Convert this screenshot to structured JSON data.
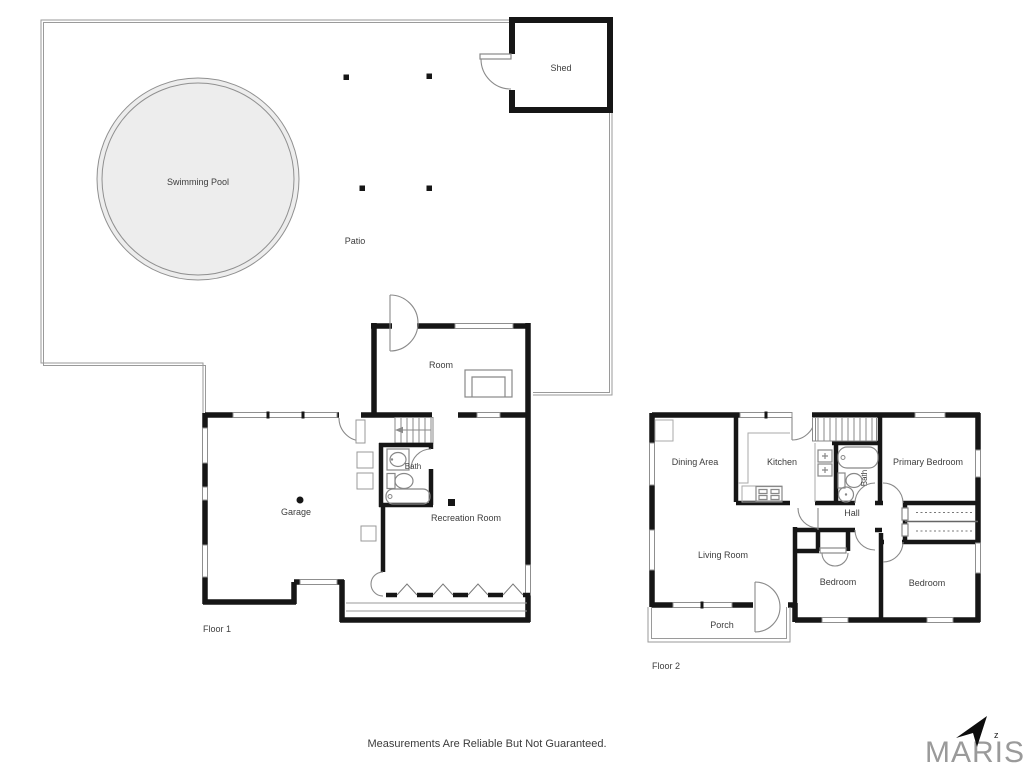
{
  "site": {
    "labels": {
      "swimming_pool": "Swimming Pool",
      "patio": "Patio",
      "shed": "Shed"
    }
  },
  "floor1": {
    "title": "Floor 1",
    "labels": {
      "room": "Room",
      "garage": "Garage",
      "bath": "Bath",
      "recreation_room": "Recreation Room"
    }
  },
  "floor2": {
    "title": "Floor 2",
    "labels": {
      "dining_area": "Dining Area",
      "kitchen": "Kitchen",
      "primary_bedroom": "Primary Bedroom",
      "bath": "Bath",
      "hall": "Hall",
      "living_room": "Living Room",
      "bedroom_middle": "Bedroom",
      "bedroom_right": "Bedroom",
      "porch": "Porch"
    }
  },
  "footer": {
    "disclaimer": "Measurements Are Reliable But Not Guaranteed."
  },
  "branding": {
    "logo_text": "MARIS",
    "north_letter": "z"
  },
  "colors": {
    "walls": "#161616",
    "windows": "#8f8f8f",
    "pool_fill": "#ededed",
    "site_outline": "#9a9a9a",
    "label_text": "#3d3d3d",
    "brand_gray": "#9a9a9a"
  }
}
